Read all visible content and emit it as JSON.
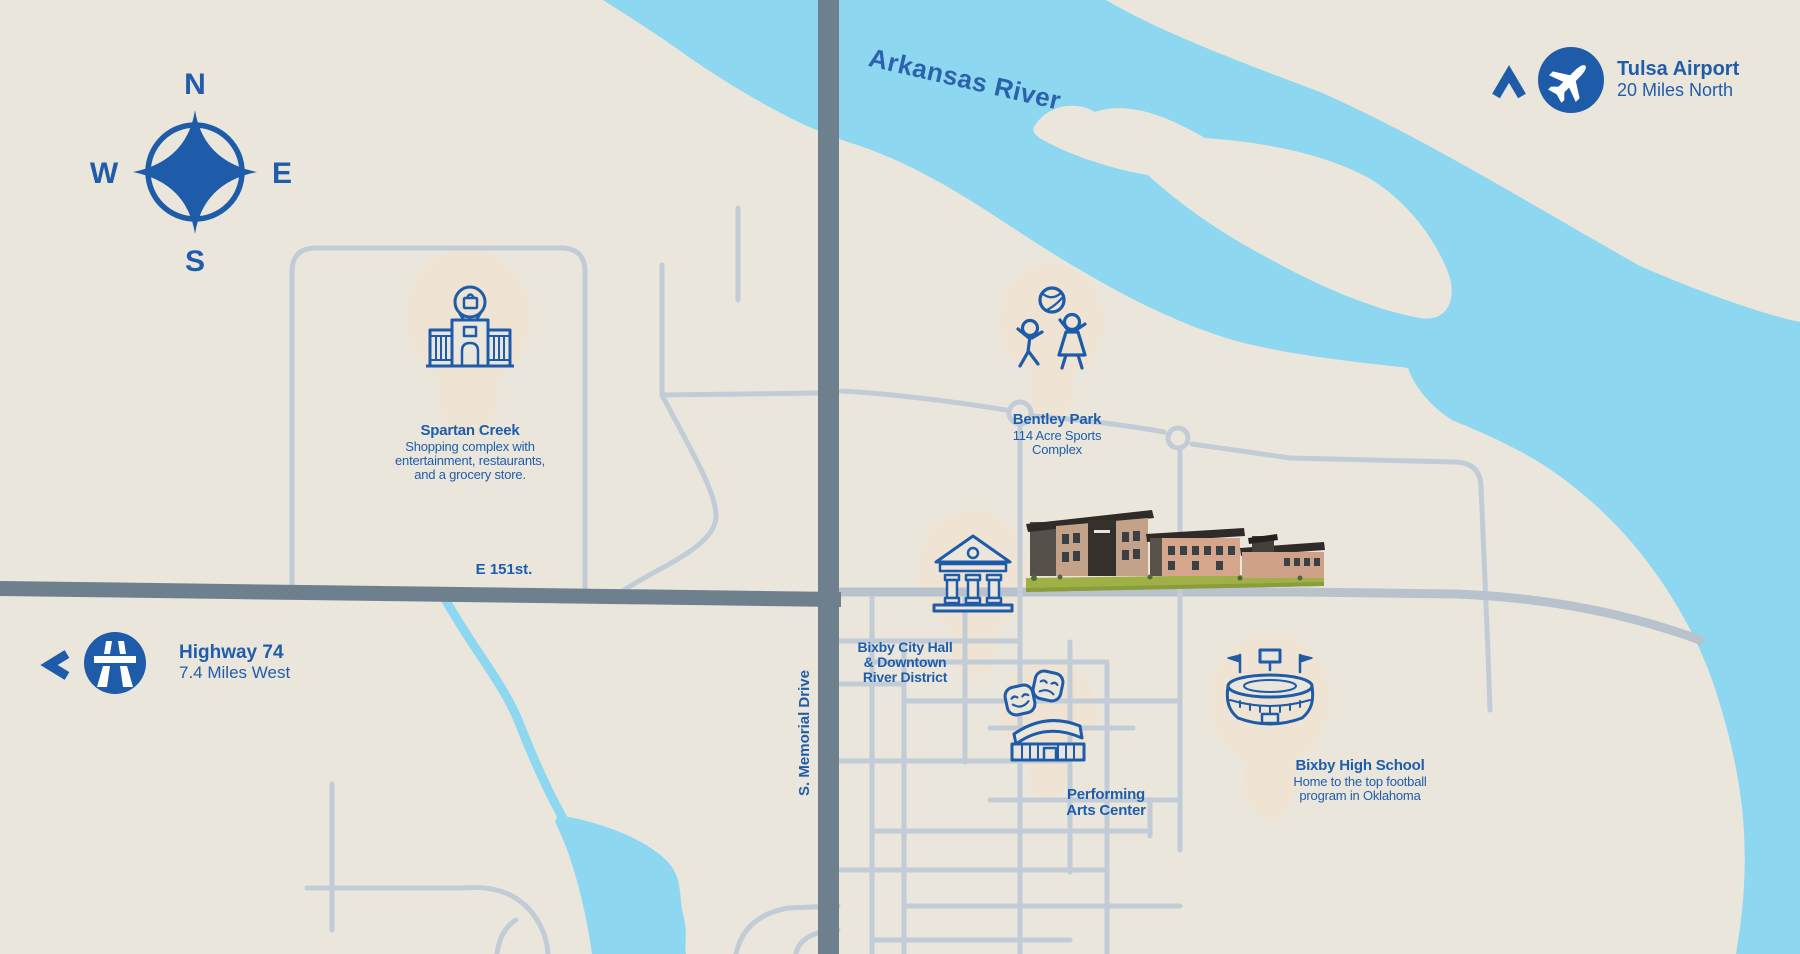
{
  "compass": {
    "n": "N",
    "e": "E",
    "s": "S",
    "w": "W"
  },
  "river": {
    "label": "Arkansas River"
  },
  "roads": {
    "e151": {
      "label": "E 151st."
    },
    "memorial": {
      "label": "S. Memorial Drive"
    }
  },
  "markers": {
    "tulsa_airport": {
      "title": "Tulsa Airport",
      "subtitle": "20 Miles North",
      "icon": "airplane-icon",
      "direction_icon": "north-chevron-icon"
    },
    "highway_74": {
      "title": "Highway 74",
      "subtitle": "7.4 Miles West",
      "icon": "motorway-icon",
      "direction_icon": "west-chevron-icon"
    }
  },
  "pois": {
    "spartan_creek": {
      "title": "Spartan Creek",
      "lines": [
        "Shopping complex with",
        "entertainment, restaurants,",
        "and a grocery store."
      ],
      "icon": "shopping-center-icon"
    },
    "bentley_park": {
      "title": "Bentley Park",
      "lines": [
        "114 Acre Sports",
        "Complex"
      ],
      "icon": "kids-playing-icon"
    },
    "city_hall": {
      "lines": [
        "Bixby City Hall",
        "& Downtown",
        "River District"
      ],
      "icon": "city-hall-icon"
    },
    "performing_arts": {
      "lines": [
        "Performing",
        "Arts Center"
      ],
      "icon": "theater-masks-icon"
    },
    "high_school": {
      "title": "Bixby High School",
      "lines": [
        "Home to the top football",
        "program in Oklahoma"
      ],
      "icon": "stadium-icon"
    }
  },
  "colors": {
    "accent_blue": "#1e5ba8",
    "text_blue": "#1f5dab",
    "river_blue": "#8ed7f0",
    "land_cream": "#ebe6dc",
    "road_minor": "#c2ccd6",
    "road_major": "#6e7f8e",
    "watercolor_blob": "#f3e2cd",
    "grass_green": "#9eb046"
  }
}
